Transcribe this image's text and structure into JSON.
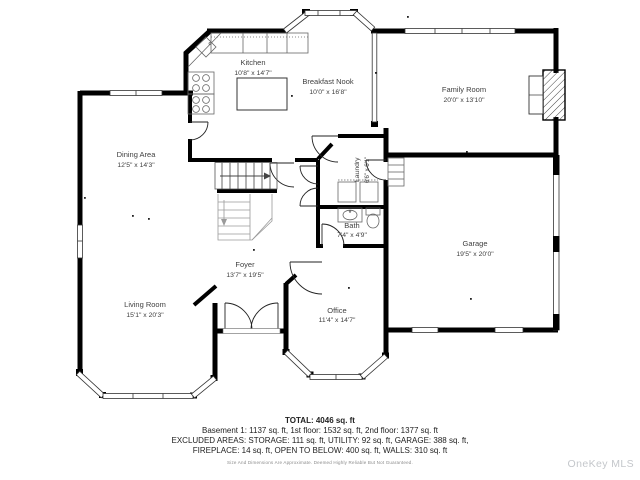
{
  "floor_plan": {
    "rooms": [
      {
        "id": "kitchen",
        "name": "Kitchen",
        "dims": "10'8\" x 14'7\""
      },
      {
        "id": "breakfast-nook",
        "name": "Breakfast Nook",
        "dims": "10'0\" x 16'8\""
      },
      {
        "id": "family-room",
        "name": "Family Room",
        "dims": "20'0\" x 13'10\""
      },
      {
        "id": "dining-area",
        "name": "Dining Area",
        "dims": "12'5\" x 14'3\""
      },
      {
        "id": "laundry",
        "name": "Laundry",
        "dims": "6'6\" x 6'1\""
      },
      {
        "id": "bath",
        "name": "Bath",
        "dims": "7'4\" x 4'9\""
      },
      {
        "id": "garage",
        "name": "Garage",
        "dims": "19'5\" x 20'0\""
      },
      {
        "id": "foyer",
        "name": "Foyer",
        "dims": "13'7\" x 19'5\""
      },
      {
        "id": "living-room",
        "name": "Living Room",
        "dims": "15'1\" x 20'3\""
      },
      {
        "id": "office",
        "name": "Office",
        "dims": "11'4\" x 14'7\""
      }
    ],
    "colors": {
      "wall": "#000000",
      "fixture": "#666666",
      "open_below": "#9a9a9a",
      "label": "#3f3f3f"
    }
  },
  "summary": {
    "total": "TOTAL: 4046 sq. ft",
    "floors": "Basement 1: 1137 sq. ft, 1st floor: 1532 sq. ft, 2nd floor: 1377 sq. ft",
    "excluded_1": "EXCLUDED AREAS: STORAGE: 111 sq. ft, UTILITY: 92 sq. ft, GARAGE: 388 sq. ft,",
    "excluded_2": "FIREPLACE: 14 sq. ft, OPEN TO BELOW: 400 sq. ft, WALLS: 310 sq. ft",
    "disclaimer": "Size And Dimensions Are Approximate. Deemed Highly Reliable But Not Guaranteed."
  },
  "watermark": "OneKey MLS"
}
